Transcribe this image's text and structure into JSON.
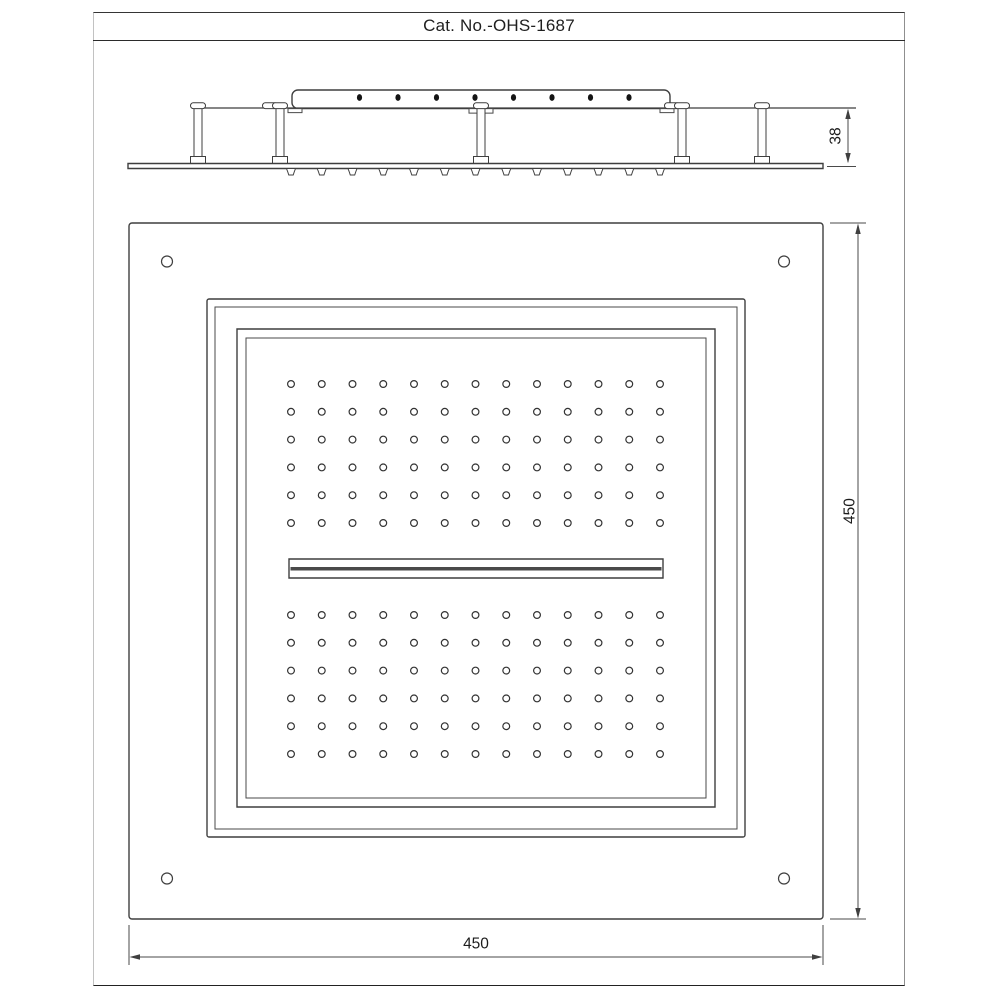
{
  "title": "Cat. No.-OHS-1687",
  "side_view": {
    "label": "side elevation",
    "height_dim_label": "38",
    "bracket_hole_count": 8,
    "nozzle_count": 13,
    "post_count": 5
  },
  "plan_view": {
    "label": "bottom plan",
    "width_dim_label": "450",
    "height_dim_label": "450",
    "corner_hole_count": 4,
    "spray_grid": {
      "columns": 13,
      "rows_per_block": 6,
      "blocks": 2
    },
    "has_center_waterfall_slot": true
  },
  "colors": {
    "line": "#3f3f3f",
    "hole_fill": "#141414",
    "slot_bar": "#4a4a4a",
    "background": "#ffffff"
  }
}
